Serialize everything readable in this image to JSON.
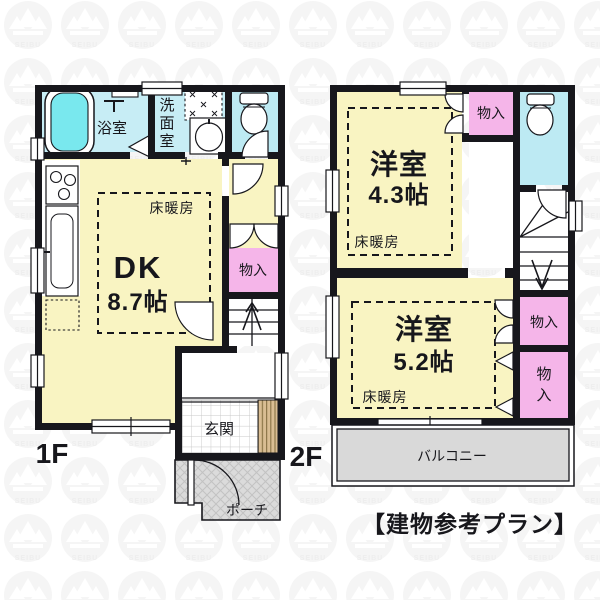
{
  "caption": "【建物参考プラン】",
  "watermark": {
    "brand": "SEIBU"
  },
  "f1": {
    "floor_label": "1F",
    "bathroom": "浴室",
    "washroom_chars": [
      "洗",
      "面",
      "室"
    ],
    "dk_name": "DK",
    "dk_size": "8.7帖",
    "floor_heating": "床暖房",
    "closet": "物入",
    "entrance": "玄関",
    "porch": "ポーチ"
  },
  "f2": {
    "floor_label": "2F",
    "room_a_name": "洋室",
    "room_a_size": "4.3帖",
    "room_a_heating": "床暖房",
    "closet_top": "物入",
    "room_b_name": "洋室",
    "room_b_size": "5.2帖",
    "room_b_heating": "床暖房",
    "closet_mid": "物入",
    "closet_bottom_chars": [
      "物",
      "入"
    ],
    "balcony": "バルコニー"
  },
  "colors": {
    "wall": "#17171c",
    "room_yellow": "#f9f4c2",
    "wet_cyan": "#c7edf5",
    "tub_cyan": "#79e8ee",
    "closet_pink": "#f5b5e9",
    "slab_gray": "#d9d9d9",
    "cabinet_tan": "#d9bd93"
  }
}
